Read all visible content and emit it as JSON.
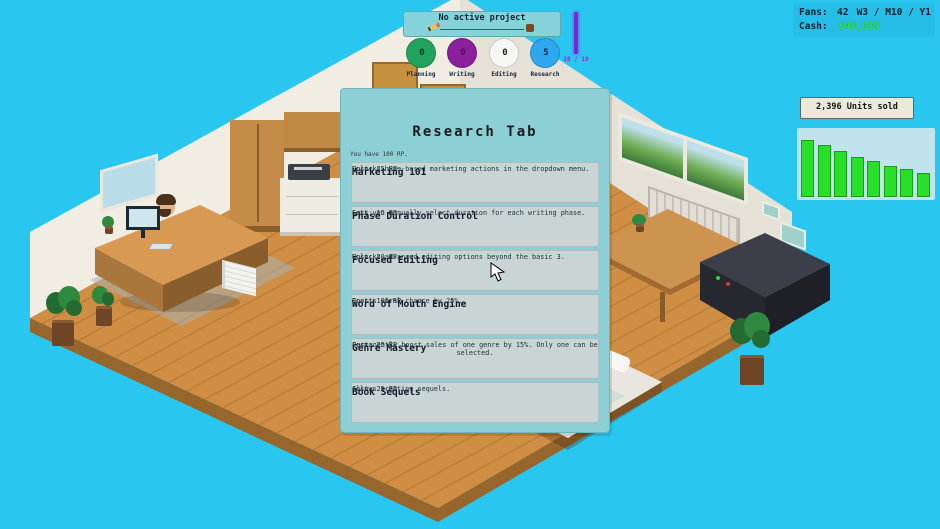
{
  "top_bar": {
    "title": "No active project",
    "phases": [
      {
        "label": "Planning",
        "value": "0",
        "color": "#1fa35d",
        "text_color": "#0b3b22"
      },
      {
        "label": "Writing",
        "value": "0",
        "color": "#8b1f9c",
        "text_color": "#4d1054"
      },
      {
        "label": "Editing",
        "value": "0",
        "color": "#f6f6f4",
        "text_color": "#222222"
      },
      {
        "label": "Research",
        "value": "5",
        "color": "#2fa7ee",
        "text_color": "#0b2b4c"
      }
    ],
    "xp_label": "10 / 10"
  },
  "stats": {
    "fans_label": "Fans:",
    "fans_value": "42",
    "date": "W3 / M10 / Y1",
    "cash_label": "Cash:",
    "cash_value": "$40,039",
    "cash_color": "#35e23c"
  },
  "units_sold": {
    "label": "2,396 Units sold",
    "bar_color": "#29e029",
    "chart_type": "bar",
    "values": [
      57,
      52,
      46,
      40,
      36,
      31,
      28,
      24
    ]
  },
  "research": {
    "title": "Research Tab",
    "subtitle": "You have 100 RP.",
    "items": [
      {
        "title": "Marketing 101",
        "desc": "Unlocks hype-based marketing actions in the dropdown menu.",
        "cost": "Cost: 25 RP"
      },
      {
        "title": "Phase Duration Control",
        "desc": "Lets you manually select duration for each writing phase.",
        "cost": "Cost: 15 RP"
      },
      {
        "title": "Focused Editing",
        "desc": "Unlocks advanced editing options beyond the basic 3.",
        "cost": "Cost: 20 RP"
      },
      {
        "title": "Word of Mouth Engine",
        "desc": "Boosts viral chance by 25%.",
        "cost": "Cost: 100 RP"
      },
      {
        "title": "Genre Mastery",
        "desc": "Permanently boost sales of one genre by 15%. Only one can be selected.",
        "cost": "Cost: 25 RP"
      },
      {
        "title": "Book Sequels",
        "desc": "Allows creating sequels.",
        "cost": "Cost: 25 RP"
      }
    ]
  }
}
